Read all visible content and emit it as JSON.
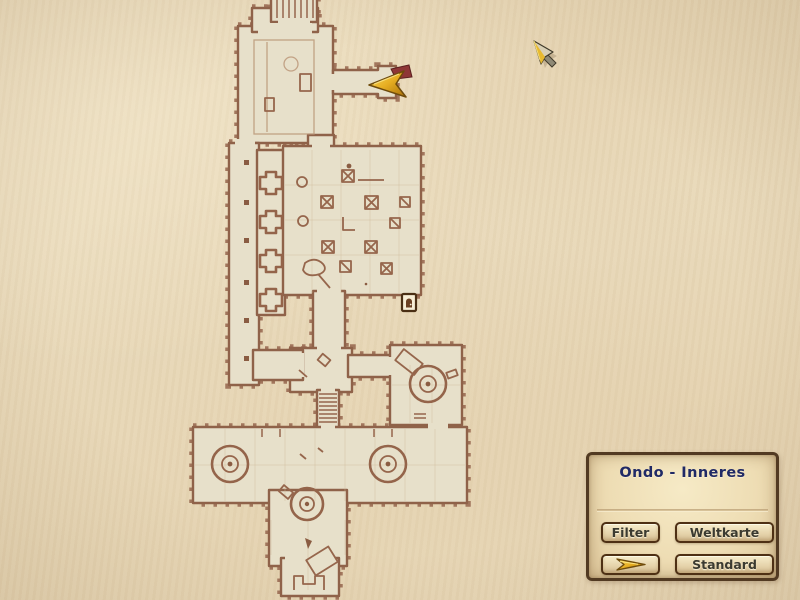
{
  "panel": {
    "title": "Ondo - Inneres",
    "buttons": {
      "filter": "Filter",
      "weltkarte": "Weltkarte",
      "standard": "Standard"
    }
  },
  "map": {
    "location_name": "Ondo - Inneres",
    "markers": {
      "player": "player-location-arrow-icon",
      "door": "door-icon"
    }
  },
  "icons": {
    "center_button_arrow": "gold-arrow-icon",
    "cursor": "mouse-cursor-arrow-icon"
  },
  "colors": {
    "parchment": "#e9dabb",
    "room_fill": "#e7e0ca",
    "wall": "#9b6e55",
    "panel_border": "#523a22",
    "title_text": "#202a66",
    "button_text": "#3b3a30",
    "marker_gold": "#e7ae22",
    "marker_maroon": "#8e3636"
  }
}
